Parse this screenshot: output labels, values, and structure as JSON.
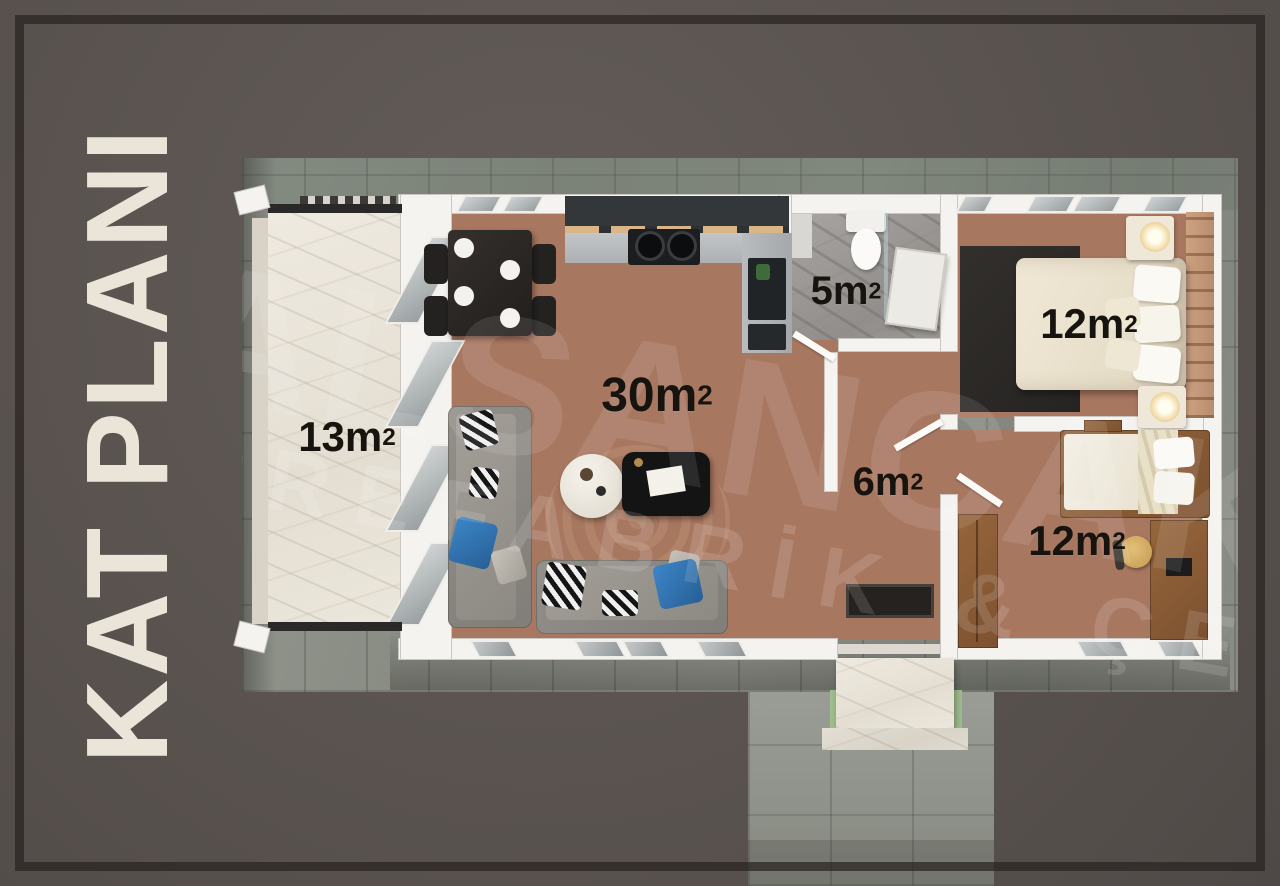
{
  "poster": {
    "title": "KAT PLANI"
  },
  "watermark": {
    "line1": "ALSANCAK",
    "line2": "PREFABRİK & ÇELİK"
  },
  "rooms": {
    "terrace": {
      "label": "13m²",
      "base": "13m",
      "sup": "2"
    },
    "living": {
      "label": "30m²",
      "base": "30m",
      "sup": "2"
    },
    "bathroom": {
      "label": "5m²",
      "base": "5m",
      "sup": "2"
    },
    "hall": {
      "label": "6m²",
      "base": "6m",
      "sup": "2"
    },
    "bedroom1": {
      "label": "12m²",
      "base": "12m",
      "sup": "2"
    },
    "bedroom2": {
      "label": "12m²",
      "base": "12m",
      "sup": "2"
    }
  },
  "colors": {
    "background": "#5b5450",
    "frame_line": "#2f2b29",
    "title_text": "#ebe4d8",
    "label_text": "#17140f",
    "accent_pillow_blue": "#2f74b5",
    "wood_floor": "#a87760",
    "patio_tile": "#8b8f86"
  }
}
